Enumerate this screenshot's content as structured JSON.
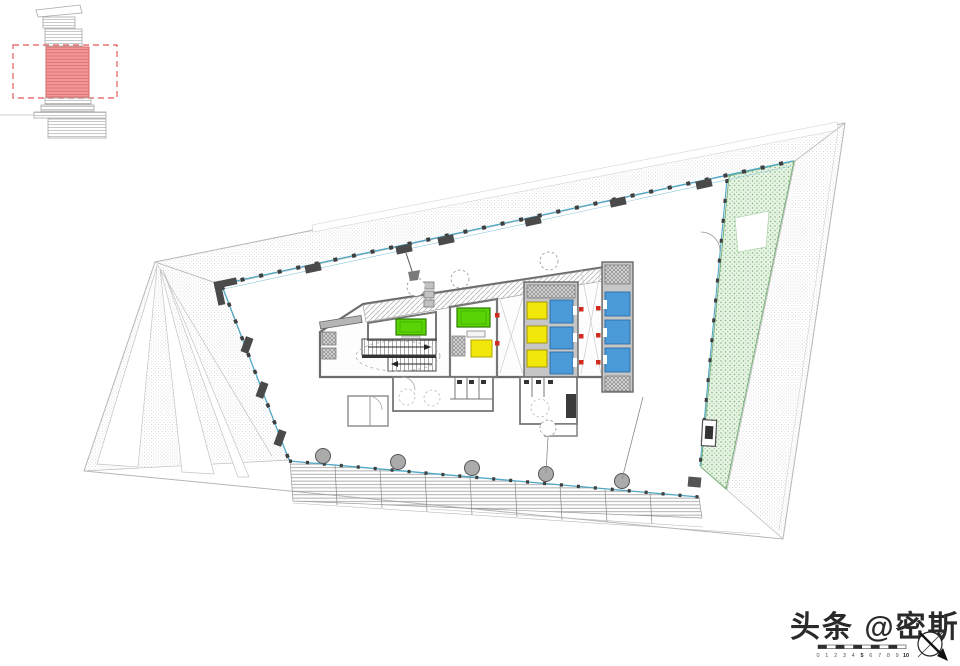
{
  "key_plan": {
    "description": "tower section key diagram with highlighted floor range",
    "highlight_fill": "#f2989a",
    "highlight_line": "#dd6e6e",
    "dash_border": "#e57373",
    "line_color": "#a8a8a8"
  },
  "colors": {
    "facade_glass": "#4fa8c6",
    "mullion_dark": "#3f3f3f",
    "wall": "#6b6b6b",
    "wall_fill": "#c6c6c6",
    "garden_fill": "#e7f3e3",
    "garden_dot": "#72b072",
    "elevator_blue": "#4a9ad8",
    "elevator_yellow": "#f2e70a",
    "equipment_green": "#5ad406",
    "marker_red": "#cf2b1e",
    "column_gray": "#ababab"
  },
  "core": {
    "yellow_elevators": 3,
    "blue_elevators_left_bank": 3,
    "blue_elevators_right_bank": 3,
    "green_equipment_rooms": 2,
    "yellow_rooms": 1
  },
  "garden": {
    "label": "planted-terrace"
  },
  "watermark": {
    "text": "头条 @密斯氮"
  },
  "scale_bar": {
    "labels": [
      "0",
      "1",
      "2",
      "3",
      "4",
      "5",
      "6",
      "7",
      "8",
      "9",
      "10"
    ]
  },
  "compass": {
    "type": "north-arrow"
  }
}
